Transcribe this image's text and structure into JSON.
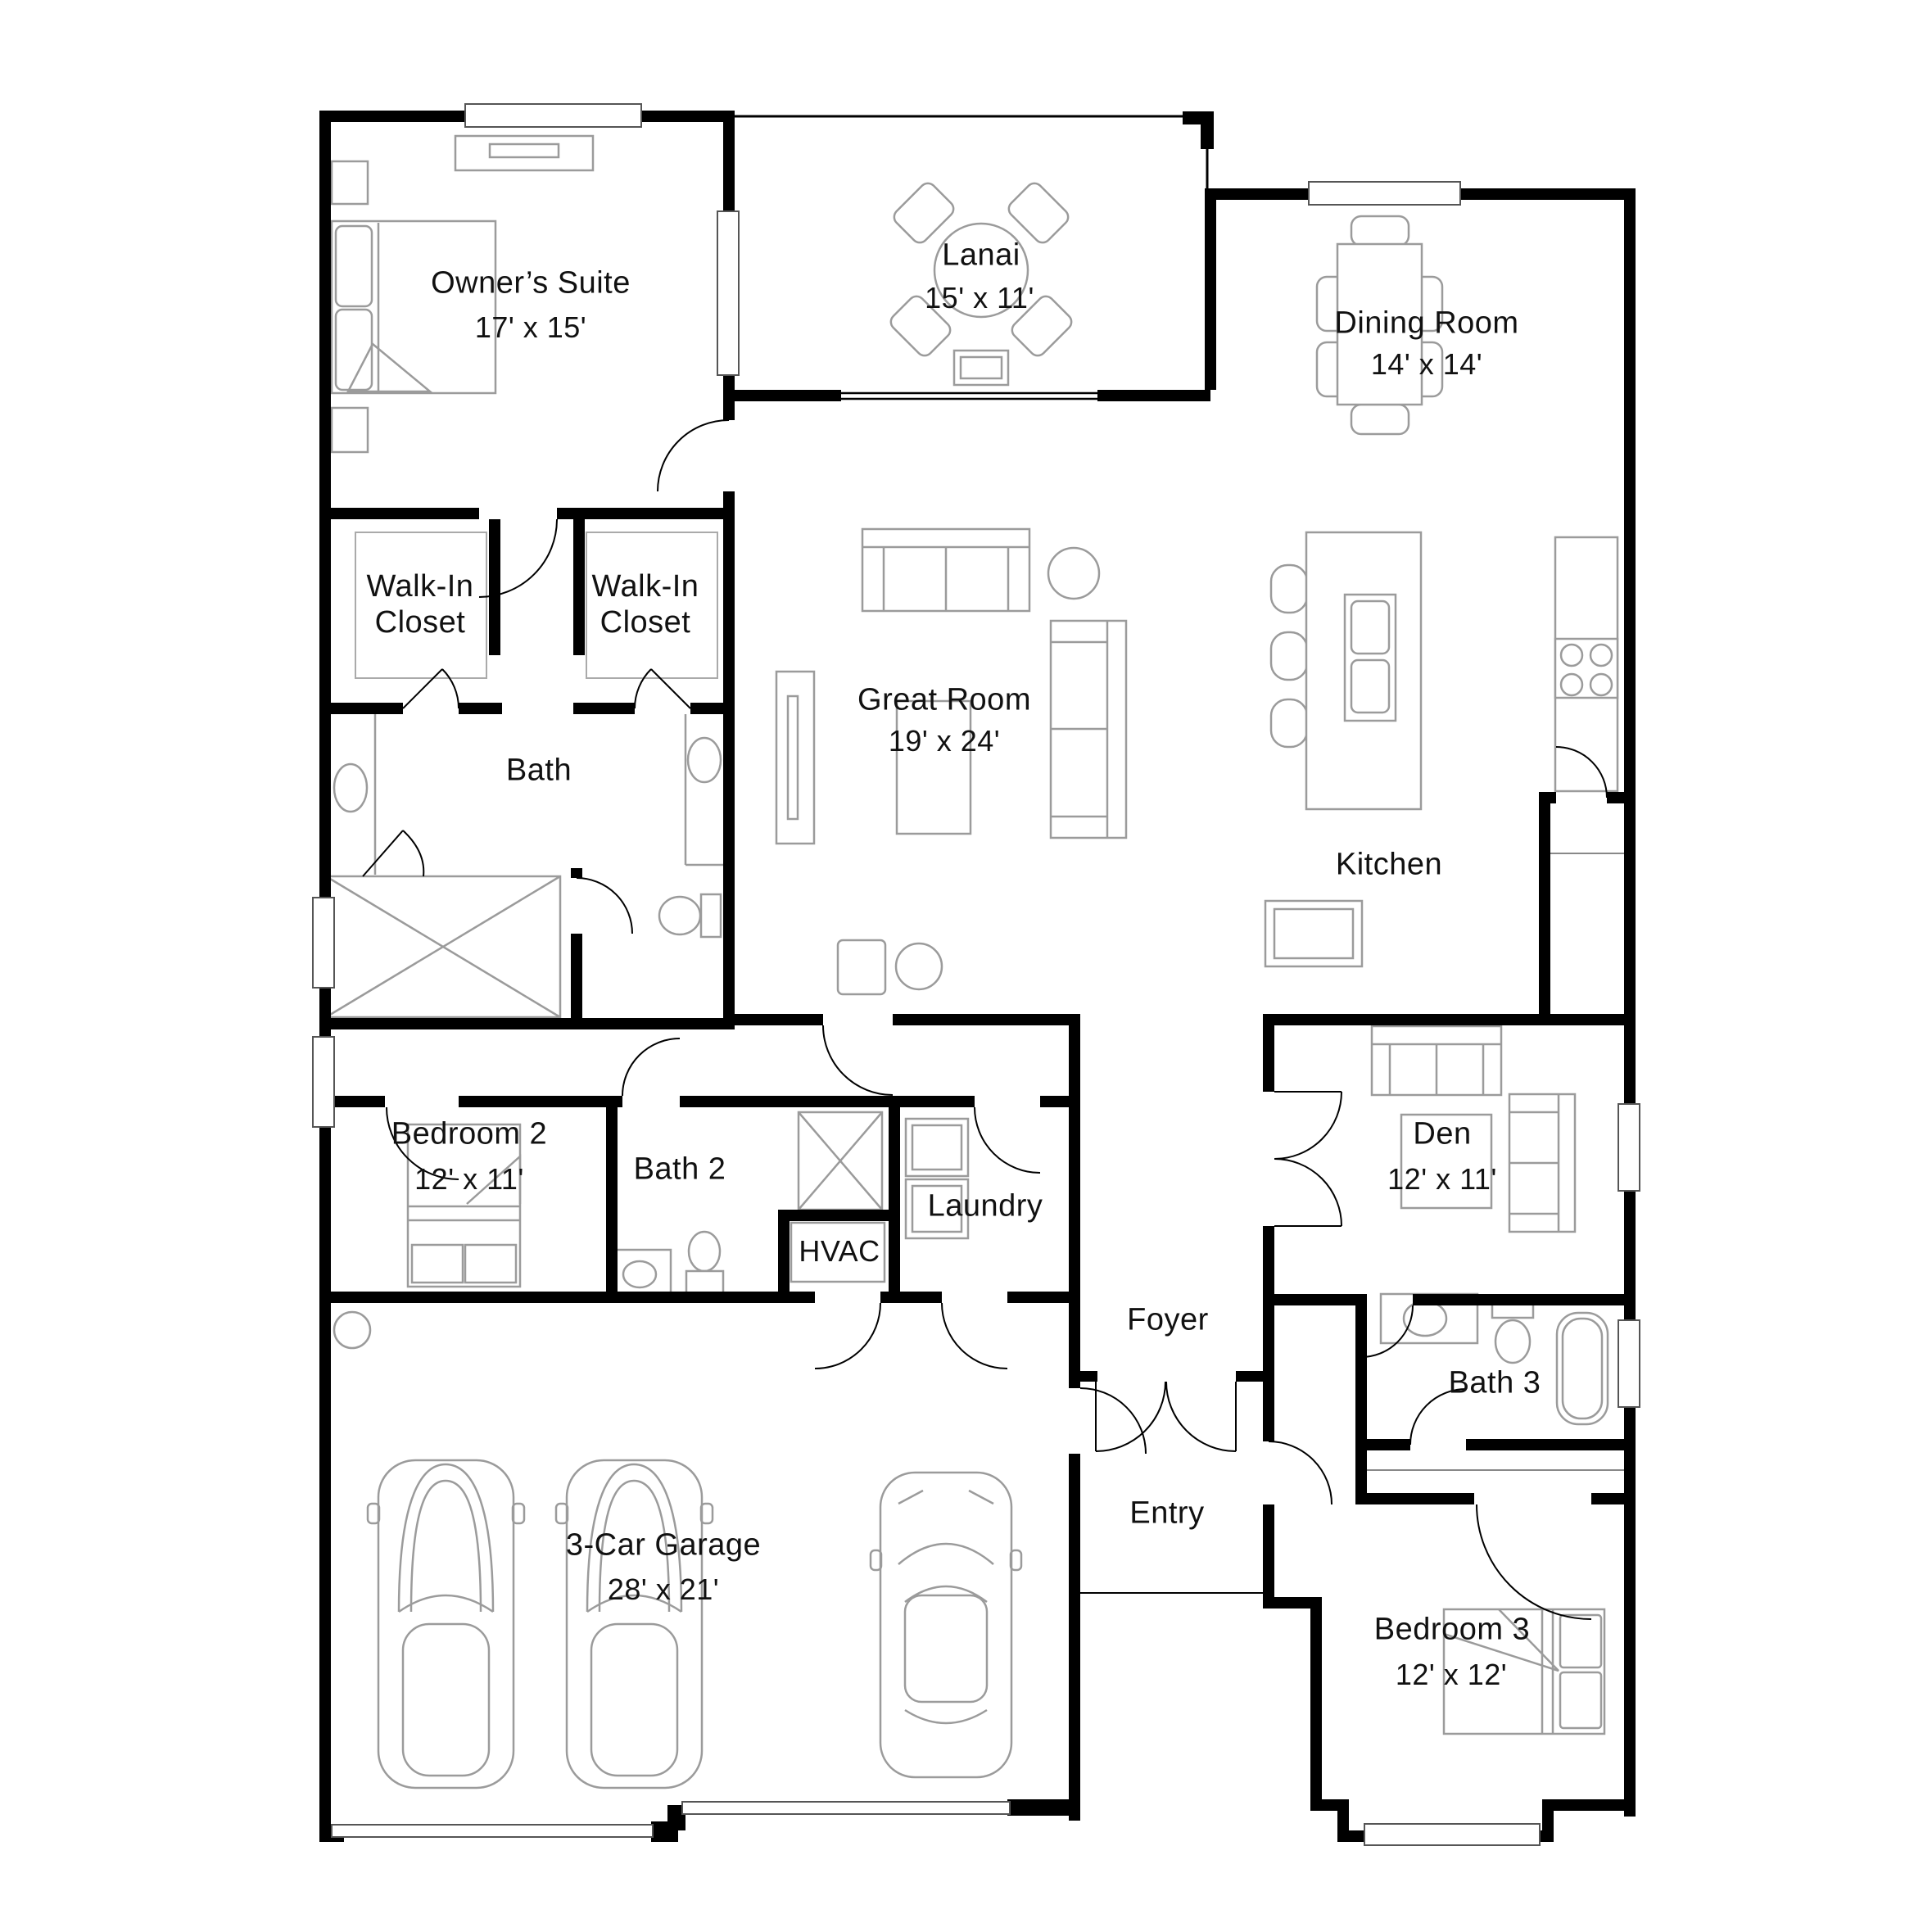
{
  "plan": {
    "title": "Single-story home floor plan",
    "rooms": {
      "owners_suite": {
        "label": "Owner’s Suite",
        "dims": "17' x 15'"
      },
      "lanai": {
        "label": "Lanai",
        "dims": "15' x 11'"
      },
      "dining_room": {
        "label": "Dining Room",
        "dims": "14' x 14'"
      },
      "walk_in_closet_left": {
        "line1": "Walk-In",
        "line2": "Closet"
      },
      "walk_in_closet_right": {
        "line1": "Walk-In",
        "line2": "Closet"
      },
      "bath": {
        "label": "Bath"
      },
      "great_room": {
        "label": "Great Room",
        "dims": "19' x 24'"
      },
      "kitchen": {
        "label": "Kitchen"
      },
      "bedroom_2": {
        "label": "Bedroom 2",
        "dims": "12' x 11'"
      },
      "bath_2": {
        "label": "Bath 2"
      },
      "laundry": {
        "label": "Laundry"
      },
      "hvac": {
        "label": "HVAC"
      },
      "den": {
        "label": "Den",
        "dims": "12' x 11'"
      },
      "foyer": {
        "label": "Foyer"
      },
      "bath_3": {
        "label": "Bath 3"
      },
      "entry": {
        "label": "Entry"
      },
      "garage": {
        "label": "3-Car Garage",
        "dims": "28' x 21'"
      },
      "bedroom_3": {
        "label": "Bedroom 3",
        "dims": "12' x 12'"
      }
    },
    "colors": {
      "walls": "#000000",
      "furniture_outline": "#9b9b9b",
      "window_outline": "#555555",
      "background": "#ffffff",
      "text": "#111111"
    }
  }
}
